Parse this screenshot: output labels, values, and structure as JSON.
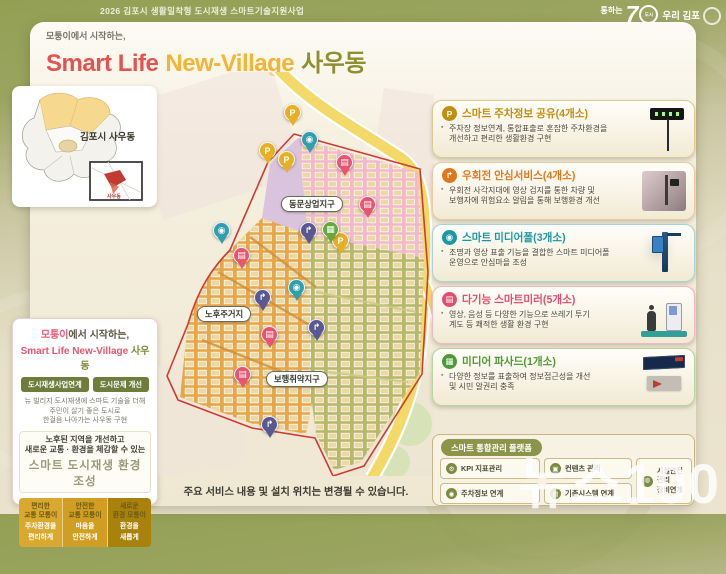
{
  "page": {
    "program_title": "2026 김포시 생활밀착형 도시재생 스마트기술지원사업",
    "footnote": "주요 서비스 내용 및 설치 위치는 변경될 수 있습니다.",
    "watermark": "뉴스100"
  },
  "logo": {
    "tagline": "통하는",
    "big": "7",
    "ring": "도시",
    "suffix": "우리 김포"
  },
  "hero": {
    "kicker": "모퉁이에서 시작하는,",
    "title_1": "Smart Life",
    "title_2": "New-Village",
    "title_3": "사우동"
  },
  "mini_map": {
    "label": "김포시 사우동",
    "inset_label": "사우동"
  },
  "left_panel": {
    "kicker_highlight": "모퉁이",
    "kicker_rest": "에서 시작하는,",
    "title_en": "Smart Life New-Village",
    "title_ko": " 사우동",
    "button_1": "도시재생사업연계",
    "button_2": "도시문제 개선",
    "desc": "뉴 빌리지 도시재생에 스마트 기술을 더해\n주민이 살기 좋은 도시로\n한걸음 나아가는 사우동 구현",
    "goal_lines": "노후된 지역을 개선하고\n새로운 교통 · 환경을 체감할 수 있는",
    "goal_title": "스마트 도시재생 환경 조성",
    "pillars": [
      {
        "line1": "편리한",
        "line2": "교통 모퉁이",
        "line3": "주차환경을",
        "line4": "편리하게"
      },
      {
        "line1": "안전한",
        "line2": "교통 모퉁이",
        "line3": "마음을",
        "line4": "안전하게"
      },
      {
        "line1": "새로운",
        "line2": "환경 모퉁이",
        "line3": "환경을",
        "line4": "새롭게"
      }
    ]
  },
  "map": {
    "zone_labels": [
      "동문상업지구",
      "노후주거지",
      "보행취약지구"
    ],
    "pin_glyphs": {
      "parking": "P",
      "rightturn": "↱",
      "mediapole": "◉",
      "mirror": "▤",
      "facade": "▦"
    },
    "pins": [
      {
        "type": "parking",
        "x": 293,
        "y": 128
      },
      {
        "type": "parking",
        "x": 268,
        "y": 166
      },
      {
        "type": "parking",
        "x": 287,
        "y": 175
      },
      {
        "type": "parking",
        "x": 341,
        "y": 256
      },
      {
        "type": "mediapole",
        "x": 310,
        "y": 155
      },
      {
        "type": "mediapole",
        "x": 222,
        "y": 246
      },
      {
        "type": "mediapole",
        "x": 297,
        "y": 303
      },
      {
        "type": "rightturn",
        "x": 309,
        "y": 246
      },
      {
        "type": "rightturn",
        "x": 263,
        "y": 313
      },
      {
        "type": "rightturn",
        "x": 317,
        "y": 343
      },
      {
        "type": "rightturn",
        "x": 270,
        "y": 440
      },
      {
        "type": "mirror",
        "x": 345,
        "y": 178
      },
      {
        "type": "mirror",
        "x": 368,
        "y": 220
      },
      {
        "type": "mirror",
        "x": 242,
        "y": 271
      },
      {
        "type": "mirror",
        "x": 270,
        "y": 350
      },
      {
        "type": "mirror",
        "x": 243,
        "y": 390
      },
      {
        "type": "facade",
        "x": 331,
        "y": 245
      }
    ]
  },
  "services": [
    {
      "title": "스마트 주차정보 공유(4개소)",
      "badge": "P",
      "desc": "주차장 정보연계, 통합표출로 혼잡한 주차환경을\n개선하고 편리한 생활환경 구현",
      "accent": "#c28d10",
      "border": "#e0c98c"
    },
    {
      "title": "우회전 안심서비스(4개소)",
      "badge": "↱",
      "desc": "우회전 사각지대에 영상 검지를 통한 차량 및\n보행자에 위험요소 알림을 통해 보행환경 개선",
      "accent": "#e2761c",
      "border": "#ecc9a0"
    },
    {
      "title": "스마트 미디어폴(3개소)",
      "badge": "◉",
      "desc": "조명과 영상 표출 기능을 결합한 스마트 미디어폴\n운영으로 안심마을 조성",
      "accent": "#1a98a4",
      "border": "#a8d4d4"
    },
    {
      "title": "다기능 스마트미러(5개소)",
      "badge": "▤",
      "desc": "영상, 음성 등 다양한 기능으로 쓰레기 투기\n계도 등 쾌적한 생활 환경 구현",
      "accent": "#e14e6e",
      "border": "#f0b8c4"
    },
    {
      "title": "미디어 파사드(1개소)",
      "badge": "▦",
      "desc": "다양한 정보를 표출하여 정보접근성을 개선\n및 시민 알권리 충족",
      "accent": "#4e9a34",
      "border": "#b8d4a0"
    }
  ],
  "platform": {
    "title": "스마트 통합관리 플랫폼",
    "items": [
      "KPI 지표관리",
      "컨텐츠 관리",
      "주차정보 연계",
      "기존시스템 연계"
    ],
    "icons": [
      "⚙",
      "▣",
      "◉",
      "▤"
    ],
    "side": "시설안전관리\n장비연계",
    "side_icon": "◍"
  },
  "colors": {
    "header_olive": "#93a054",
    "title_red": "#e4534f",
    "title_yellow": "#f2b535",
    "title_olive": "#8e8f31",
    "zone_pink": "#f2b9cb",
    "zone_orange": "#e6a74b",
    "zone_green": "#b7b86b",
    "boundary_red": "#cf3b33"
  }
}
